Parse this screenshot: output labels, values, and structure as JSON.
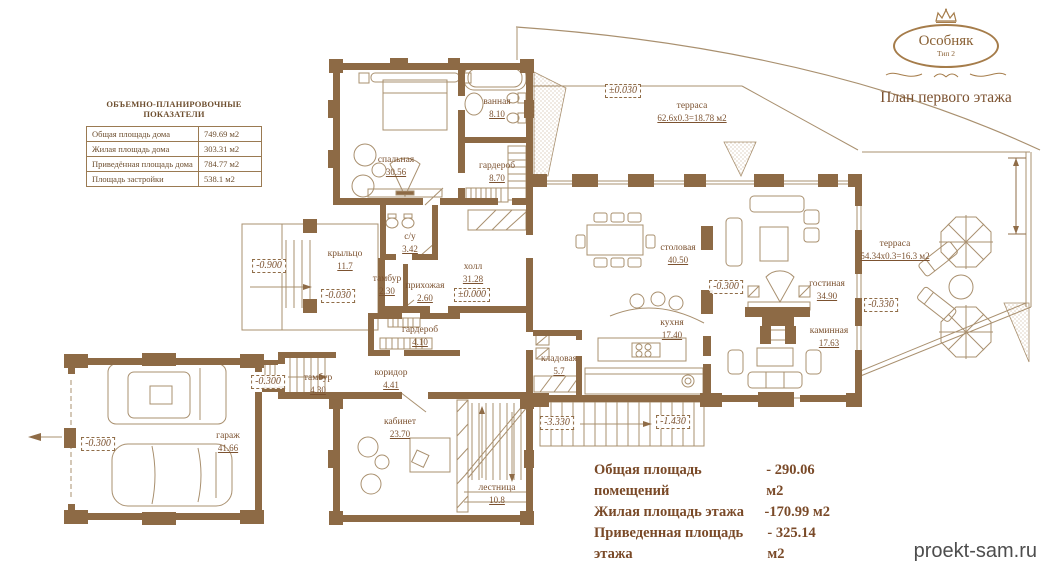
{
  "logo": {
    "title": "Особняк",
    "subtitle": "Тип 2",
    "caption": "План первого этажа"
  },
  "indicators_table": {
    "title": "ОБЪЕМНО-ПЛАНИРОВОЧНЫЕ ПОКАЗАТЕЛИ",
    "rows": [
      {
        "label": "Общая площадь дома",
        "value": "749.69 м2"
      },
      {
        "label": "Жилая площадь дома",
        "value": "303.31 м2"
      },
      {
        "label": "Приведённая площадь дома",
        "value": "784.77 м2"
      },
      {
        "label": "Площадь застройки",
        "value": "538.1 м2"
      }
    ]
  },
  "rooms": [
    {
      "name": "спальная",
      "area": "30.56"
    },
    {
      "name": "ванная",
      "area": "8.10"
    },
    {
      "name": "гардероб",
      "area": "8.70"
    },
    {
      "name": "терраса",
      "area": "62.6x0.3=18.78 м2"
    },
    {
      "name": "с/у",
      "area": "3.42"
    },
    {
      "name": "крыльцо",
      "area": "11.7"
    },
    {
      "name": "тамбур",
      "area": "2.30"
    },
    {
      "name": "прихожая",
      "area": "2.60"
    },
    {
      "name": "холл",
      "area": "31.28"
    },
    {
      "name": "столовая",
      "area": "40.50"
    },
    {
      "name": "гостиная",
      "area": "34.90"
    },
    {
      "name": "кухня",
      "area": "17.40"
    },
    {
      "name": "кладовая",
      "area": "5.7"
    },
    {
      "name": "каминная",
      "area": "17.63"
    },
    {
      "name": "терраса",
      "area": "54.34x0.3=16.3 м2"
    },
    {
      "name": "гардероб",
      "area": "4.10"
    },
    {
      "name": "тамбур",
      "area": "4.30"
    },
    {
      "name": "коридор",
      "area": "4.41"
    },
    {
      "name": "кабинет",
      "area": "23.70"
    },
    {
      "name": "гараж",
      "area": "41.66"
    },
    {
      "name": "лестница",
      "area": "10.8"
    }
  ],
  "elevations": [
    {
      "value": "±0.030"
    },
    {
      "value": "-0.900"
    },
    {
      "value": "-0.030"
    },
    {
      "value": "±0.000"
    },
    {
      "value": "-0.300"
    },
    {
      "value": "-0.330"
    },
    {
      "value": "-0.300"
    },
    {
      "value": "-0.300"
    },
    {
      "value": "-3.330"
    },
    {
      "value": "-1.430"
    }
  ],
  "summary": {
    "lines": [
      {
        "label": "Общая площадь помещений",
        "value": "- 290.06 м2"
      },
      {
        "label": "Жилая площадь этажа",
        "value": "-170.99 м2"
      },
      {
        "label": "Приведенная площадь этажа",
        "value": "- 325.14 м2"
      }
    ]
  },
  "watermark": "proekt-sam.ru",
  "colors": {
    "wall": "#8d6a45",
    "line": "#a9906f",
    "text": "#7c5230"
  }
}
